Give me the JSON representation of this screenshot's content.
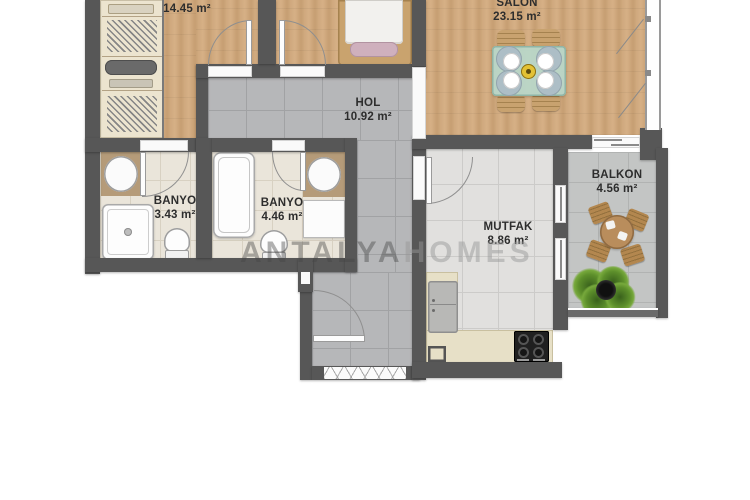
{
  "watermark": {
    "part1": "ANTALYA",
    "part2": "HOMES"
  },
  "rooms": {
    "bedroom": {
      "name": "ODA",
      "area": "14.45 m²"
    },
    "salon": {
      "name": "SALON",
      "area": "23.15 m²"
    },
    "hall": {
      "name": "HOL",
      "area": "10.92 m²"
    },
    "bathroom1": {
      "name": "BANYO",
      "area": "3.43 m²"
    },
    "bathroom2": {
      "name": "BANYO",
      "area": "4.46 m²"
    },
    "kitchen": {
      "name": "MUTFAK",
      "area": "8.86 m²"
    },
    "balcony": {
      "name": "BALKON",
      "area": "4.56 m²"
    }
  },
  "colors": {
    "wall": "#575757",
    "wood_floor": "#cda77c",
    "hall_tile": "#b6b7b9",
    "bath_tile": "#eae5da",
    "kitchen_tile": "#e1e0de",
    "balcony_tile": "#c3c5c4",
    "dining_table": "#b9d8cb",
    "ornament_yellow": "#e3c235"
  }
}
